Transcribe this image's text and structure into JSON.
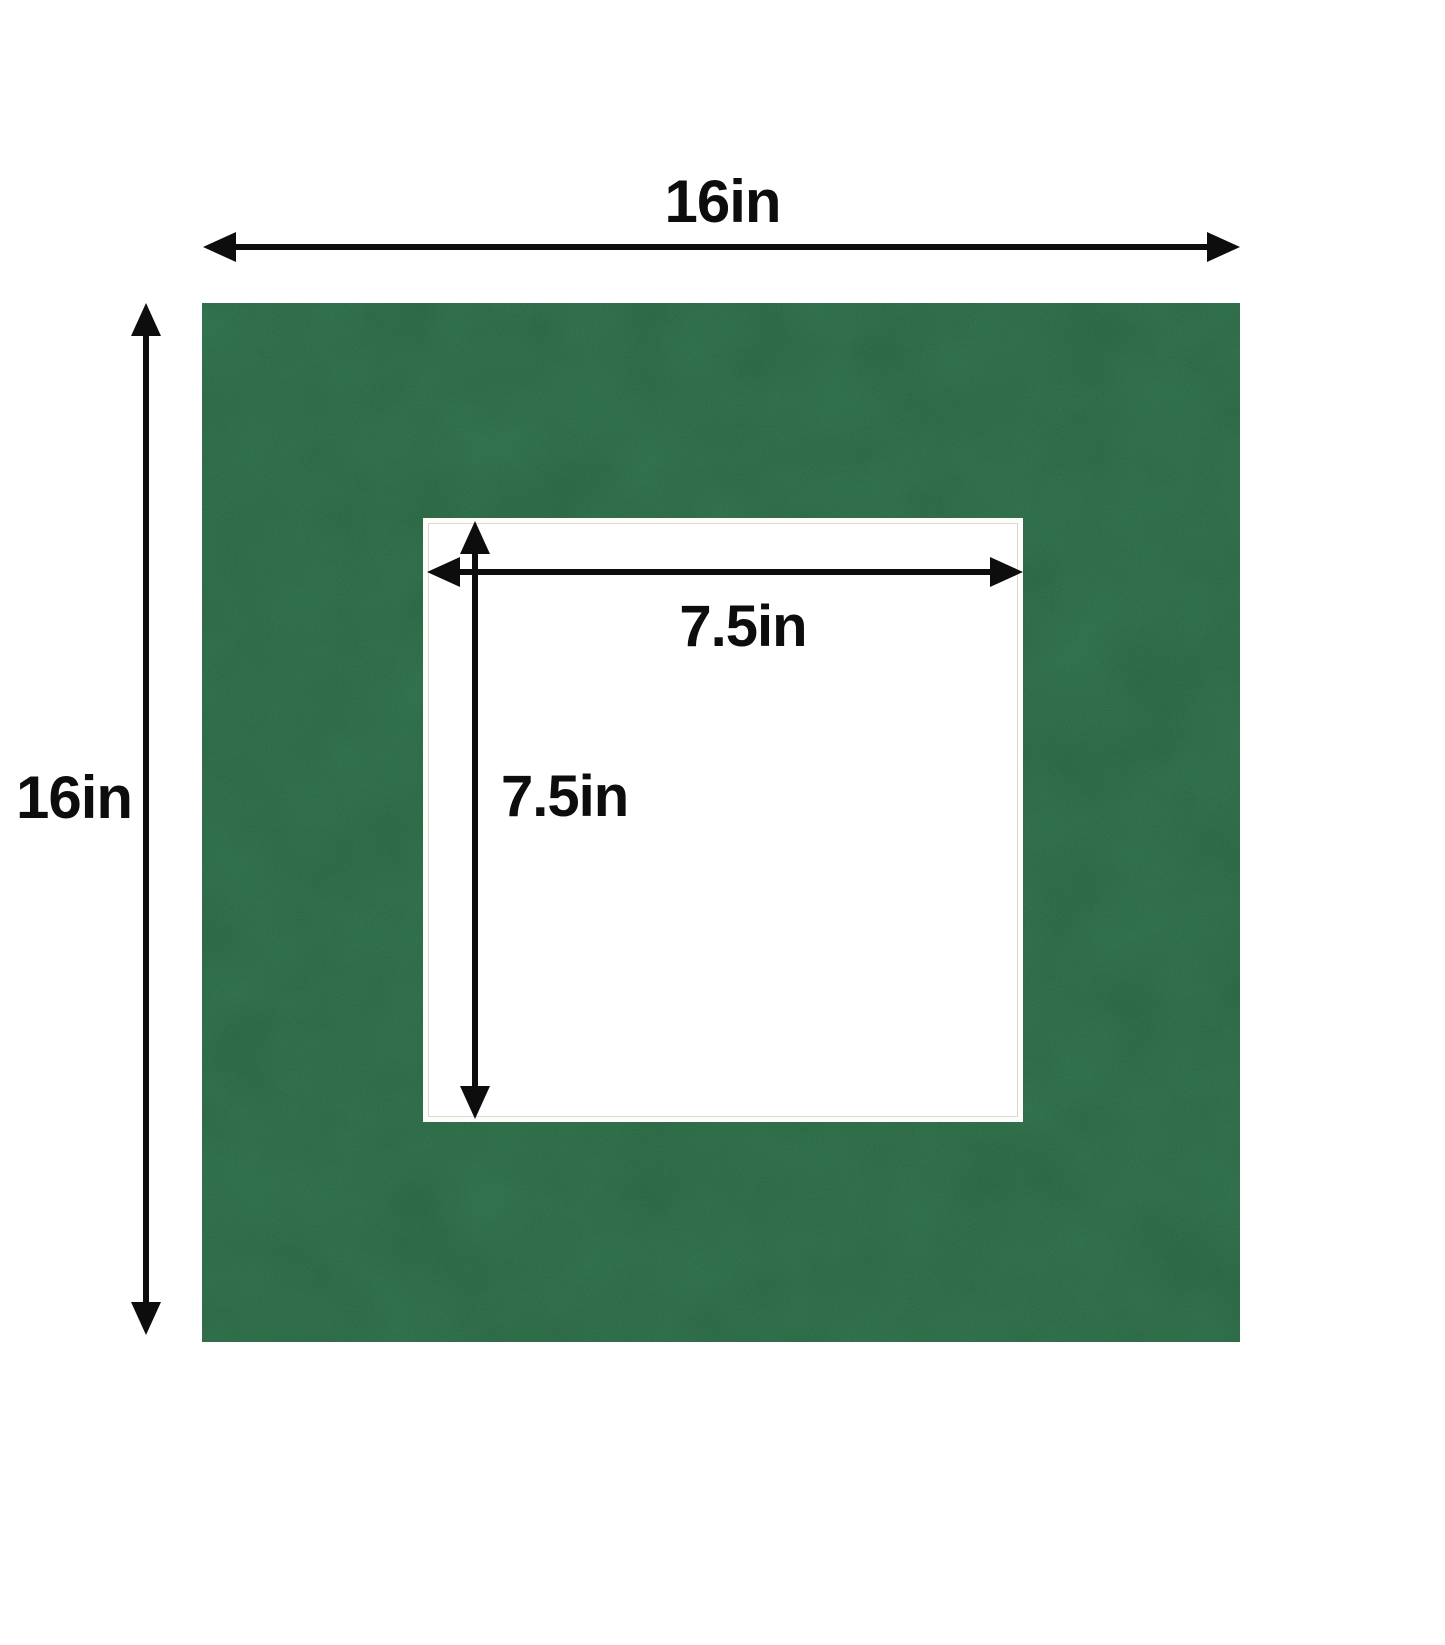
{
  "diagram": {
    "title": "picture-mat-dimension-diagram",
    "outer_mat": {
      "width_label": "16in",
      "height_label": "16in"
    },
    "window_opening": {
      "width_label": "7.5in",
      "height_label": "7.5in"
    },
    "icons": {
      "dimension_arrow": "double-headed-arrow"
    },
    "colors": {
      "mat_suede_green": "#1d5a35",
      "mat_speckle_green": "#5a8f6e",
      "mat_shadow_green": "#0e3c20",
      "arrow_black": "#0d0d0d",
      "opening_white": "#ffffff",
      "bevel_white": "#fdfdfa",
      "bevel_line_gray": "#d9d9d3",
      "background": "#ffffff"
    }
  }
}
